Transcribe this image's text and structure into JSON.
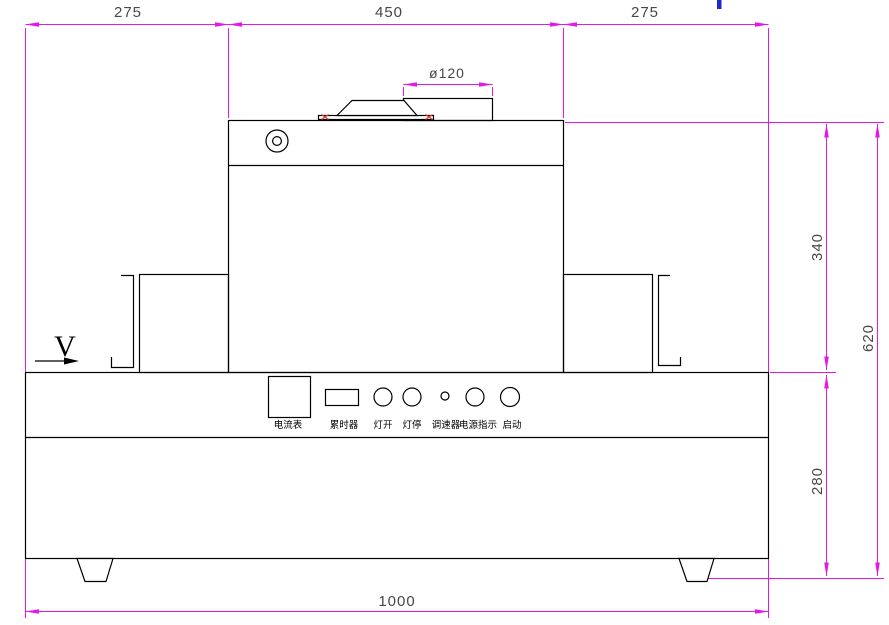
{
  "drawing": {
    "type": "engineering-front-view-drawing",
    "colors": {
      "outline": "#000000",
      "dimension": "#e617e6",
      "dim_text": "#474747",
      "red_marker": "#dd4433",
      "blue_mark": "#2328c8",
      "label_text": "#000000"
    },
    "dimensions": {
      "top_left": "275",
      "top_center": "450",
      "top_right": "275",
      "duct": "ø120",
      "lamp_housing_height": "340",
      "overall_height": "620",
      "base_height": "280",
      "overall_width": "1000"
    },
    "direction_label": "V",
    "control_panel": {
      "items": [
        {
          "label": "电流表"
        },
        {
          "label": "累时器"
        },
        {
          "label": "灯开"
        },
        {
          "label": "灯停"
        },
        {
          "label": "调速器"
        },
        {
          "label": "电源指示"
        },
        {
          "label": "启动"
        }
      ]
    }
  }
}
